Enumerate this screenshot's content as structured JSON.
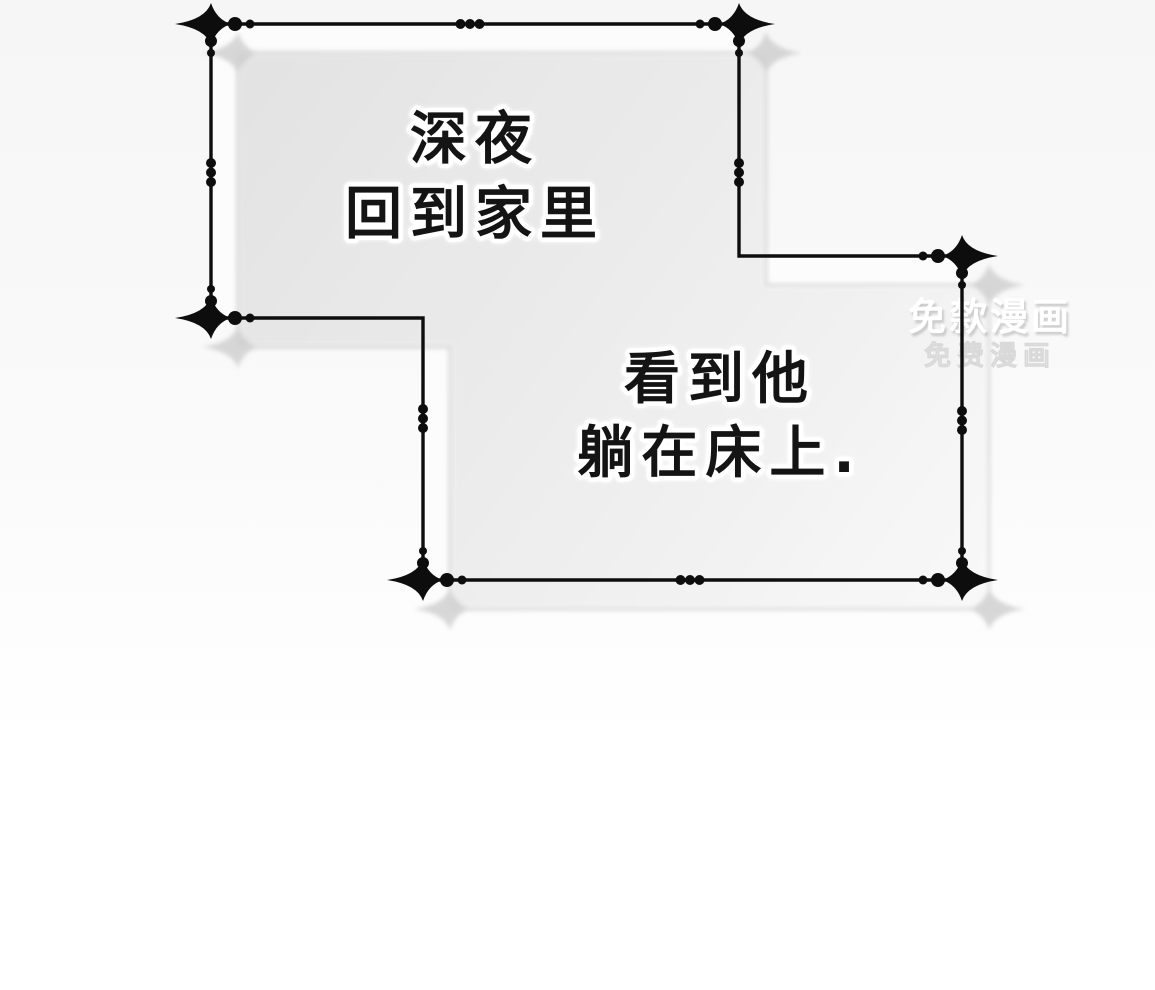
{
  "page": {
    "kind": "webtoon-comic-page",
    "background_color": "#f7f7f7"
  },
  "panels": [
    {
      "id": "panel-1",
      "lines": [
        "深夜",
        "回到家里"
      ]
    },
    {
      "id": "panel-2",
      "lines": [
        "看到他",
        "躺在床上."
      ]
    }
  ],
  "watermark": {
    "line1": "免歀漫画",
    "line2": "免费漫画"
  },
  "colors": {
    "ink": "#0d0d0d",
    "text_ink": "#141414",
    "text_halo": "#ffffff",
    "panel_fill": "#fcfcfc",
    "panel_shade_dark": "#e3e3e3",
    "panel_shade_light": "#fbfbfb",
    "ornament_shadow": "#c9c9c9",
    "watermark_main": "#ffffff",
    "watermark_sub": "#efefef"
  }
}
